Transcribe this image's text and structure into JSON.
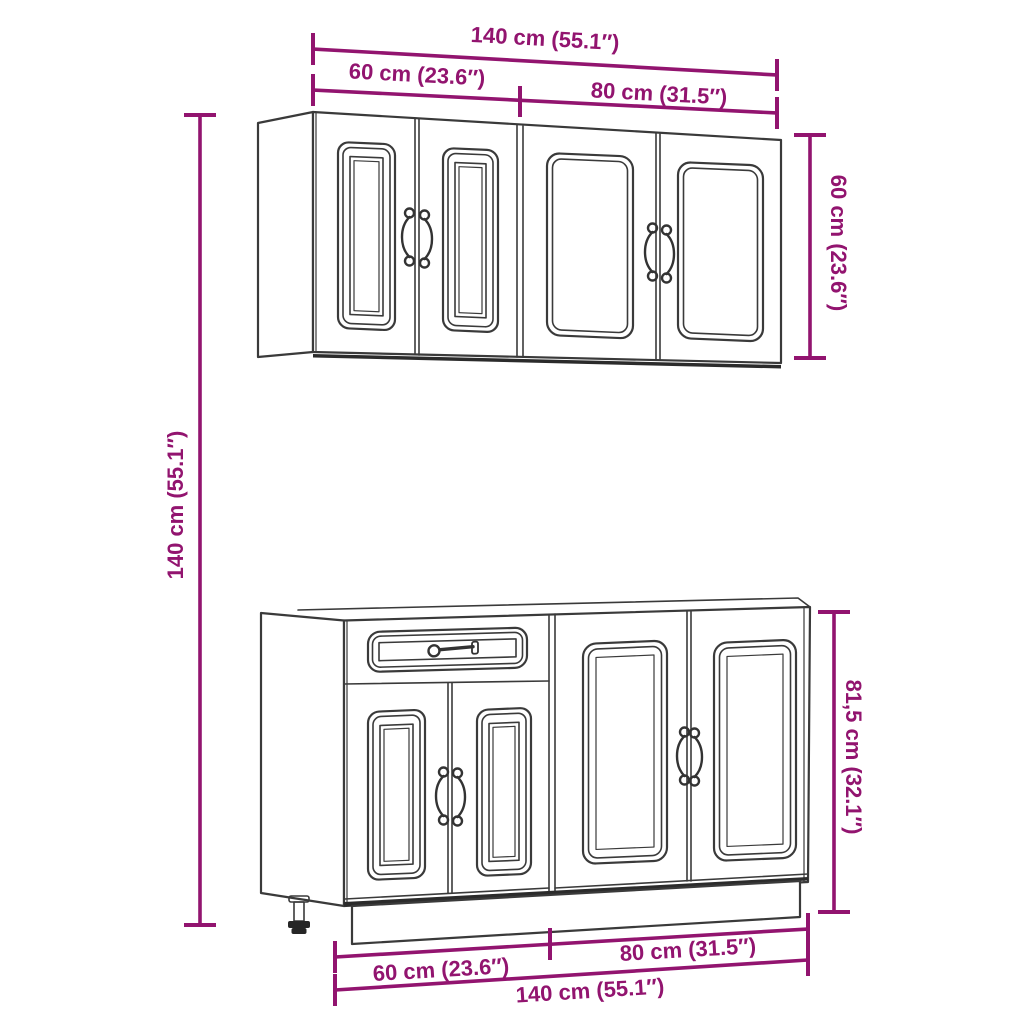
{
  "diagram": {
    "labels": {
      "top_width_total": "140 cm (55.1″)",
      "top_width_left": "60 cm (23.6″)",
      "top_width_right": "80 cm (31.5″)",
      "left_height_total": "140 cm (55.1″)",
      "right_height_upper": "60 cm (23.6″)",
      "right_height_lower": "81,5 cm (32.1″)",
      "bottom_width_left": "60 cm (23.6″)",
      "bottom_width_right": "80 cm (31.5″)",
      "bottom_width_total": "140 cm (55.1″)"
    },
    "colors": {
      "dimension": "#92146F",
      "outline": "#3a3a3a",
      "background": "#ffffff"
    }
  }
}
